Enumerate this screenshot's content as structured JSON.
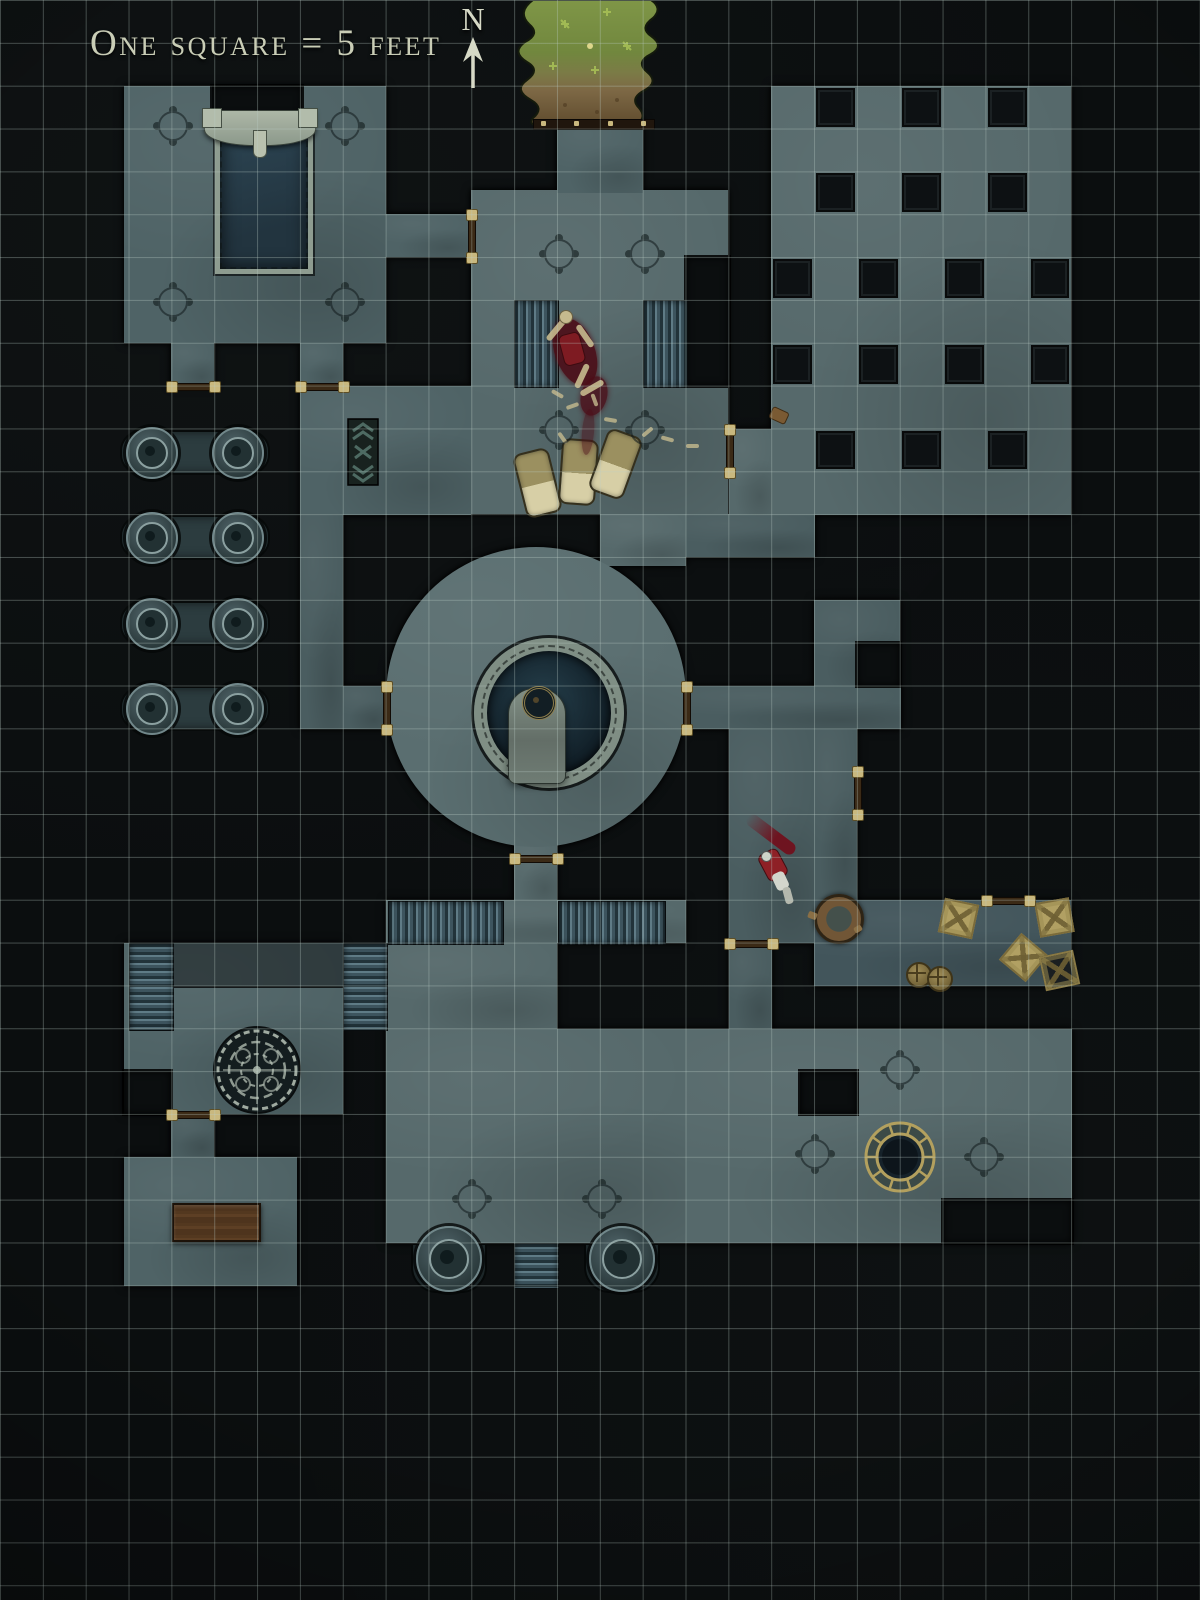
{
  "legend": {
    "scale_label": "One square = 5 feet",
    "north_label": "N"
  },
  "map": {
    "grid": {
      "cell_px": 42.857,
      "cols": 28,
      "rows": 37,
      "feet_per_square": 5
    },
    "colors": {
      "void": "#0b0e0f",
      "tones": [
        "#4f6366",
        "#56696b",
        "#4a5d60",
        "#42555b"
      ],
      "dais": "#5a6e70",
      "grid_line": "rgba(188,206,199,0.33)",
      "pillar": "#0d1113",
      "stair_light": "#5f7b86",
      "stair_dark": "#22333a",
      "door_wood": "#3b2a16",
      "door_stud": "#c9b87e",
      "water": "#22343f",
      "pool_rim": "#8e9c90",
      "grass_green": "#7f9647",
      "grass_soil": "#5f4b2d",
      "gold": "#b3a05e",
      "blood": "#4c0d17",
      "bone": "#c6ba8e",
      "bedroll": "#9b9060",
      "bedroll_sheet": "#d7cfa6",
      "crate": "#b1a063",
      "table_wood": "#53381f",
      "mosaic_line": "#b7c3b7",
      "rug_base": "#18221f",
      "rug_pattern": "#4d6a62",
      "cape_red": "#8e2026",
      "armor_white": "#d3d6cc"
    },
    "floors": [
      {
        "n": "room-northwest",
        "x": 124,
        "y": 86,
        "w": 262,
        "h": 257,
        "t": 1
      },
      {
        "n": "alcove-west",
        "x": 171,
        "y": 343,
        "w": 43,
        "h": 43,
        "t": 1
      },
      {
        "n": "alcove-east",
        "x": 300,
        "y": 343,
        "w": 43,
        "h": 43,
        "t": 1
      },
      {
        "n": "connector-passage",
        "x": 386,
        "y": 214,
        "w": 86,
        "h": 43,
        "t": 1
      },
      {
        "n": "barracks-room",
        "x": 471,
        "y": 190,
        "w": 257,
        "h": 324,
        "t": 2
      },
      {
        "n": "north-entry-corridor",
        "x": 557,
        "y": 118,
        "w": 86,
        "h": 75,
        "t": 1
      },
      {
        "n": "room-west-of-dais",
        "x": 300,
        "y": 386,
        "w": 171,
        "h": 129,
        "t": 1
      },
      {
        "n": "west-corridor",
        "x": 300,
        "y": 514,
        "w": 43,
        "h": 215,
        "t": 3
      },
      {
        "n": "west-dais-link",
        "x": 343,
        "y": 686,
        "w": 43,
        "h": 43,
        "t": 3
      },
      {
        "n": "dais-north-link",
        "x": 600,
        "y": 514,
        "w": 86,
        "h": 52,
        "t": 2
      },
      {
        "n": "east-stub-passage",
        "x": 686,
        "y": 514,
        "w": 129,
        "h": 43,
        "t": 3
      },
      {
        "n": "pillared-hall",
        "x": 771,
        "y": 86,
        "w": 300,
        "h": 429,
        "t": 2
      },
      {
        "n": "hall-door-bay",
        "x": 729,
        "y": 429,
        "w": 43,
        "h": 86,
        "t": 2
      },
      {
        "n": "mid-east-room",
        "x": 814,
        "y": 600,
        "w": 86,
        "h": 86,
        "t": 3
      },
      {
        "n": "east-band-passage",
        "x": 686,
        "y": 686,
        "w": 215,
        "h": 43,
        "t": 3
      },
      {
        "n": "east-corridor",
        "x": 729,
        "y": 729,
        "w": 86,
        "h": 214,
        "t": 3
      },
      {
        "n": "east-corridor-wide",
        "x": 814,
        "y": 729,
        "w": 43,
        "h": 171,
        "t": 3
      },
      {
        "n": "storage-room",
        "x": 814,
        "y": 900,
        "w": 257,
        "h": 86,
        "t": 4
      },
      {
        "n": "dais-south-corridor",
        "x": 514,
        "y": 840,
        "w": 43,
        "h": 62,
        "t": 2
      },
      {
        "n": "stair-landing",
        "x": 386,
        "y": 900,
        "w": 300,
        "h": 43,
        "t": 2
      },
      {
        "n": "south-hall-upper",
        "x": 386,
        "y": 943,
        "w": 171,
        "h": 86,
        "t": 2
      },
      {
        "n": "south-hall",
        "x": 386,
        "y": 1029,
        "w": 300,
        "h": 214,
        "t": 2
      },
      {
        "n": "well-room",
        "x": 686,
        "y": 1029,
        "w": 386,
        "h": 214,
        "t": 2
      },
      {
        "n": "well-room-link",
        "x": 729,
        "y": 943,
        "w": 43,
        "h": 86,
        "t": 3
      },
      {
        "n": "southwest-room",
        "x": 124,
        "y": 943,
        "w": 219,
        "h": 171,
        "t": 1
      },
      {
        "n": "southwest-door-corridor",
        "x": 171,
        "y": 1114,
        "w": 43,
        "h": 43,
        "t": 3
      },
      {
        "n": "southwest-lower-room",
        "x": 124,
        "y": 1157,
        "w": 173,
        "h": 129,
        "t": 1
      }
    ],
    "void_patches": [
      {
        "n": "fountain-head-notch",
        "x": 212,
        "y": 86,
        "w": 90,
        "h": 42
      },
      {
        "n": "barracks-ne-notch",
        "x": 686,
        "y": 257,
        "w": 43,
        "h": 129
      },
      {
        "n": "mid-east-notch",
        "x": 857,
        "y": 643,
        "w": 43,
        "h": 43
      },
      {
        "n": "southwest-notch",
        "x": 124,
        "y": 1071,
        "w": 47,
        "h": 43
      },
      {
        "n": "well-room-nw-notch",
        "x": 800,
        "y": 1071,
        "w": 57,
        "h": 43
      },
      {
        "n": "well-room-se-notch",
        "x": 943,
        "y": 1200,
        "w": 129,
        "h": 43
      }
    ],
    "square_pillars": [
      {
        "c": 19,
        "r": 2
      },
      {
        "c": 21,
        "r": 2
      },
      {
        "c": 23,
        "r": 2
      },
      {
        "c": 19,
        "r": 4
      },
      {
        "c": 21,
        "r": 4
      },
      {
        "c": 23,
        "r": 4
      },
      {
        "c": 18,
        "r": 6
      },
      {
        "c": 20,
        "r": 6
      },
      {
        "c": 22,
        "r": 6
      },
      {
        "c": 24,
        "r": 6
      },
      {
        "c": 18,
        "r": 8
      },
      {
        "c": 20,
        "r": 8
      },
      {
        "c": 22,
        "r": 8
      },
      {
        "c": 24,
        "r": 8
      },
      {
        "c": 19,
        "r": 10
      },
      {
        "c": 21,
        "r": 10
      },
      {
        "c": 23,
        "r": 10
      }
    ],
    "capsules": [
      {
        "x": 120,
        "y": 430,
        "w": 146,
        "h": 41,
        "pillars": [
          150,
          236
        ]
      },
      {
        "x": 120,
        "y": 515,
        "w": 146,
        "h": 41,
        "pillars": [
          150,
          236
        ]
      },
      {
        "x": 120,
        "y": 601,
        "w": 146,
        "h": 41,
        "pillars": [
          150,
          236
        ]
      },
      {
        "x": 120,
        "y": 686,
        "w": 146,
        "h": 41,
        "pillars": [
          150,
          236
        ]
      }
    ],
    "stairs": [
      {
        "n": "stairs-barracks-west",
        "x": 514,
        "y": 300,
        "w": 43,
        "h": 86,
        "o": "v"
      },
      {
        "n": "stairs-barracks-east",
        "x": 643,
        "y": 300,
        "w": 43,
        "h": 86,
        "o": "v"
      },
      {
        "n": "stairs-landing-west",
        "x": 388,
        "y": 901,
        "w": 114,
        "h": 42,
        "o": "v"
      },
      {
        "n": "stairs-landing-east",
        "x": 558,
        "y": 901,
        "w": 106,
        "h": 42,
        "o": "v"
      },
      {
        "n": "stairs-southwest-left",
        "x": 129,
        "y": 943,
        "w": 43,
        "h": 86,
        "o": "h"
      },
      {
        "n": "stairs-southwest-right",
        "x": 343,
        "y": 943,
        "w": 43,
        "h": 86,
        "o": "h"
      },
      {
        "n": "stairs-south-exit",
        "x": 514,
        "y": 1243,
        "w": 43,
        "h": 44,
        "o": "h"
      }
    ],
    "doors": [
      {
        "n": "door-west-alcove",
        "x": 171,
        "y": 386,
        "o": "h",
        "l": 43
      },
      {
        "n": "door-east-alcove",
        "x": 300,
        "y": 386,
        "o": "h",
        "l": 43
      },
      {
        "n": "door-connector",
        "x": 471,
        "y": 214,
        "o": "v",
        "l": 43
      },
      {
        "n": "door-barracks-east",
        "x": 729,
        "y": 429,
        "o": "v",
        "l": 43
      },
      {
        "n": "door-dais-east",
        "x": 686,
        "y": 686,
        "o": "v",
        "l": 43
      },
      {
        "n": "door-dais-west",
        "x": 386,
        "y": 686,
        "o": "v",
        "l": 43
      },
      {
        "n": "door-east-corridor",
        "x": 857,
        "y": 771,
        "o": "v",
        "l": 43
      },
      {
        "n": "door-dais-south",
        "x": 514,
        "y": 858,
        "o": "h",
        "l": 43
      },
      {
        "n": "door-storage-north",
        "x": 986,
        "y": 900,
        "o": "h",
        "l": 43
      },
      {
        "n": "door-well-room",
        "x": 729,
        "y": 943,
        "o": "h",
        "l": 43
      },
      {
        "n": "door-southwest",
        "x": 171,
        "y": 1114,
        "o": "h",
        "l": 43
      }
    ],
    "threshold": {
      "n": "entry-threshold",
      "x": 533,
      "y": 119,
      "w": 120,
      "h": 9
    },
    "compass_marks": [
      {
        "x": 171,
        "y": 124
      },
      {
        "x": 343,
        "y": 124
      },
      {
        "x": 171,
        "y": 300
      },
      {
        "x": 343,
        "y": 300
      },
      {
        "x": 557,
        "y": 252
      },
      {
        "x": 643,
        "y": 252
      },
      {
        "x": 557,
        "y": 428
      },
      {
        "x": 643,
        "y": 428
      },
      {
        "x": 470,
        "y": 1197
      },
      {
        "x": 600,
        "y": 1197
      },
      {
        "x": 898,
        "y": 1068
      },
      {
        "x": 813,
        "y": 1152
      },
      {
        "x": 982,
        "y": 1155
      }
    ],
    "features": {
      "dais": {
        "n": "central-dais",
        "cx": 536,
        "cy": 697,
        "r": 150
      },
      "dais_ring": {
        "n": "dais-pool-ring",
        "cx": 536,
        "cy": 700,
        "r": 62,
        "rim": 13
      },
      "tomb": {
        "n": "dais-slab",
        "x": 508,
        "y": 688,
        "w": 56,
        "h": 94
      },
      "dais_medallion": {
        "n": "dais-medallion",
        "cx": 536,
        "cy": 700,
        "r": 14
      },
      "pool": {
        "n": "reflecting-pool",
        "x": 215,
        "y": 126,
        "w": 88,
        "h": 138
      },
      "fountain": {
        "n": "fountain-head",
        "x": 204,
        "y": 110,
        "w": 110,
        "h": 34
      },
      "grass": {
        "n": "grass-courtyard",
        "x": 505,
        "y": 0,
        "w": 165,
        "h": 128
      },
      "rug": {
        "n": "patterned-rug",
        "x": 347,
        "y": 418,
        "w": 32,
        "h": 68
      },
      "mosaic": {
        "n": "mosaic-medallion",
        "cx": 257,
        "cy": 1070,
        "r": 44
      },
      "well": {
        "n": "round-well",
        "cx": 900,
        "cy": 1157,
        "r": 36
      },
      "ledge": {
        "n": "shadowed-ledge",
        "x": 171,
        "y": 943,
        "w": 172,
        "h": 43
      },
      "table": {
        "n": "wooden-table",
        "x": 172,
        "y": 1203,
        "w": 85,
        "h": 35
      },
      "bottom_pillars": [
        {
          "n": "round-pillar-south-west",
          "cx": 447,
          "cy": 1257
        },
        {
          "n": "round-pillar-south-east",
          "cx": 620,
          "cy": 1257
        }
      ],
      "bedrolls": [
        {
          "cx": 536,
          "cy": 481,
          "rot": -14
        },
        {
          "cx": 577,
          "cy": 470,
          "rot": 4
        },
        {
          "cx": 614,
          "cy": 462,
          "rot": 20
        }
      ],
      "crates": [
        {
          "cx": 957,
          "cy": 917,
          "rot": 12,
          "dark": false
        },
        {
          "cx": 1053,
          "cy": 916,
          "rot": -10,
          "dark": false
        },
        {
          "cx": 1022,
          "cy": 956,
          "rot": 40,
          "dark": false
        },
        {
          "cx": 1058,
          "cy": 969,
          "rot": -12,
          "dark": true
        }
      ],
      "barrels": [
        {
          "cx": 917,
          "cy": 973
        },
        {
          "cx": 938,
          "cy": 977
        }
      ],
      "rubble_barrel": {
        "n": "broken-barrel",
        "cx": 836,
        "cy": 916,
        "r": 22
      },
      "satchel": {
        "n": "dropped-satchel",
        "cx": 778,
        "cy": 415
      },
      "bones": [
        {
          "x": 551,
          "y": 392,
          "r": 30
        },
        {
          "x": 566,
          "y": 404,
          "r": -20
        },
        {
          "x": 588,
          "y": 398,
          "r": 70
        },
        {
          "x": 604,
          "y": 418,
          "r": 10
        },
        {
          "x": 641,
          "y": 430,
          "r": -40
        },
        {
          "x": 661,
          "y": 437,
          "r": 15
        },
        {
          "x": 686,
          "y": 444,
          "r": 0
        },
        {
          "x": 556,
          "y": 436,
          "r": 55
        }
      ],
      "skeleton_blood": {
        "blobs": [
          {
            "cx": 575,
            "cy": 352,
            "w": 40,
            "h": 70,
            "rot": -20,
            "op": 0.9
          },
          {
            "cx": 594,
            "cy": 396,
            "w": 26,
            "h": 40,
            "rot": 15,
            "op": 0.8
          },
          {
            "cx": 588,
            "cy": 432,
            "w": 12,
            "h": 46,
            "rot": 5,
            "op": 0.5
          }
        ],
        "skull": {
          "cx": 565,
          "cy": 316
        },
        "chest": {
          "cx": 571,
          "cy": 348,
          "rot": -15
        },
        "limbs": [
          {
            "cx": 556,
            "cy": 330,
            "rot": 40
          },
          {
            "cx": 585,
            "cy": 336,
            "rot": -35
          },
          {
            "cx": 582,
            "cy": 376,
            "rot": 25
          },
          {
            "cx": 592,
            "cy": 388,
            "rot": 60
          }
        ]
      },
      "fallen_knight": {
        "streak": {
          "x": 742,
          "y": 828,
          "w": 58,
          "h": 13,
          "rot": 37
        },
        "cape": {
          "cx": 772,
          "cy": 864,
          "rot": -28
        },
        "torso": {
          "cx": 781,
          "cy": 881,
          "rot": -25
        },
        "legs": {
          "cx": 788,
          "cy": 896,
          "rot": -15
        },
        "helm": {
          "cx": 766,
          "cy": 856
        }
      }
    }
  }
}
